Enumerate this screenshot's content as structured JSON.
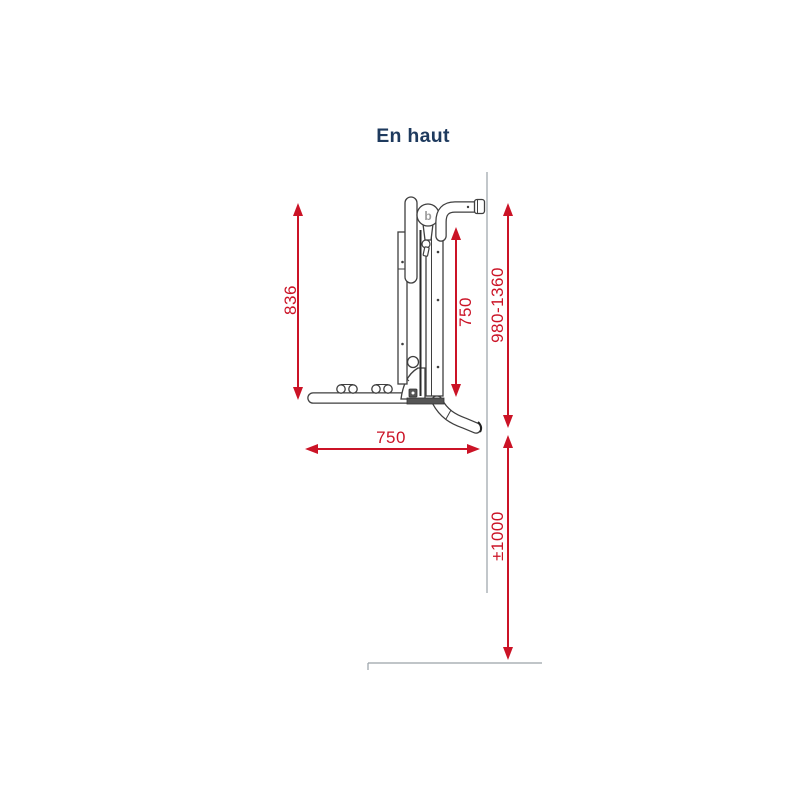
{
  "title": "En haut",
  "colors": {
    "accent-red": "#cb1326",
    "title-navy": "#1e3a5e",
    "drawing-line": "#3f3f3f",
    "guide-gray": "#9aa2a8"
  },
  "diagram": {
    "subject": "wall-mounted-bike-rack-side-view",
    "logo_letter": "b",
    "dimensions": {
      "left_height": {
        "label": "836",
        "orientation": "vertical"
      },
      "mast_height": {
        "label": "750",
        "orientation": "vertical"
      },
      "wall_mount_height": {
        "label": "980-1360",
        "orientation": "vertical"
      },
      "arm_length": {
        "label": "750",
        "orientation": "horizontal"
      },
      "ground_clearance": {
        "label": "±1000",
        "orientation": "vertical"
      }
    }
  }
}
